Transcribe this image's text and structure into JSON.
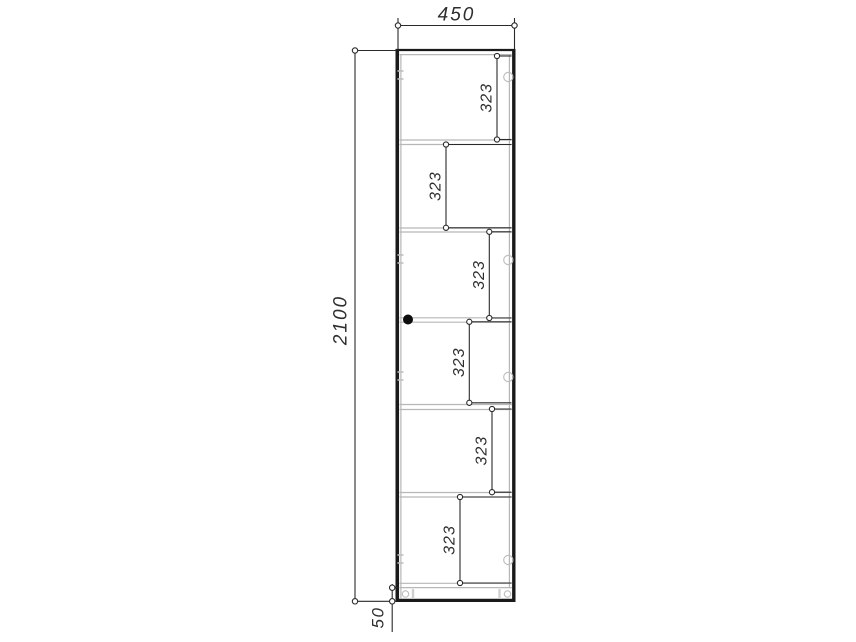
{
  "drawing": {
    "kind": "furniture-technical-drawing",
    "subject": "tall single-door cabinet, front section view with shelf spacing dimensions",
    "units": "mm",
    "colors": {
      "background": "#ffffff",
      "outline": "#1a1a1a",
      "panel_line": "#b7b7b7",
      "dimension_line": "#2a2a2a",
      "dimension_text": "#2e2e2e",
      "knob": "#0d0d0d"
    },
    "dims": {
      "width": {
        "label": "450",
        "orientation": "horizontal",
        "position": "top"
      },
      "height": {
        "label": "2100",
        "orientation": "vertical",
        "position": "left"
      },
      "plinth": {
        "label": "50",
        "orientation": "vertical",
        "position": "bottom-left"
      },
      "sections": [
        {
          "label": "323"
        },
        {
          "label": "323"
        },
        {
          "label": "323"
        },
        {
          "label": "323"
        },
        {
          "label": "323"
        },
        {
          "label": "323"
        }
      ]
    },
    "features": {
      "shelf_count": 5,
      "hinge_marks_right": 4,
      "hinge_plate_marks_left": 4,
      "plinth_cam_fittings": 2,
      "knob": 1
    }
  }
}
